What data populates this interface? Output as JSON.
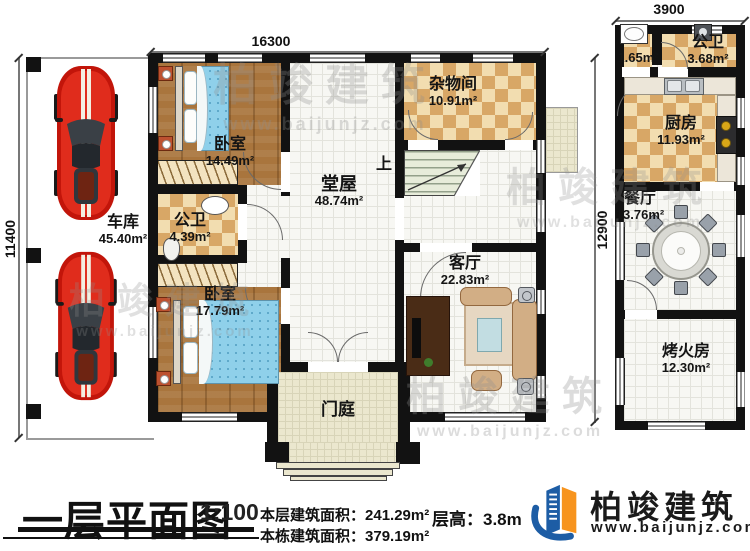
{
  "dimensions": {
    "main_width": "16300",
    "right_width": "3900",
    "left_height": "11400",
    "right_height": "12900"
  },
  "rooms": {
    "garage": {
      "name": "车库",
      "area": "45.40m²"
    },
    "bedroom1": {
      "name": "卧室",
      "area": "14.49m²"
    },
    "bath_main": {
      "name": "公卫",
      "area": "4.39m²"
    },
    "bedroom2": {
      "name": "卧室",
      "area": "17.79m²"
    },
    "hall": {
      "name": "堂屋",
      "area": "48.74m²"
    },
    "storage": {
      "name": "杂物间",
      "area": "10.91m²"
    },
    "living": {
      "name": "客厅",
      "area": "22.83m²"
    },
    "porch": {
      "name": "门庭"
    },
    "bath_small": {
      "area": "1.65m²"
    },
    "bath2": {
      "name": "公卫",
      "area": "3.68m²"
    },
    "kitchen": {
      "name": "厨房",
      "area": "11.93m²"
    },
    "dining": {
      "name": "餐厅",
      "area": "13.76m²"
    },
    "fire_room": {
      "name": "烤火房",
      "area": "12.30m²"
    }
  },
  "stairs": {
    "up_label": "上"
  },
  "title_block": {
    "plan_title": "一层平面图",
    "scale": "1:100",
    "floor_area_label": "本层建筑面积：",
    "floor_area_value": "241.29m²",
    "building_area_label": "本栋建筑面积：",
    "building_area_value": "379.19m²",
    "floor_height_label": "层高：",
    "floor_height_value": "3.8m"
  },
  "brand": {
    "name": "柏竣建筑",
    "website": "www.baijunjz.com"
  },
  "colors": {
    "wall": "#121212",
    "checker_light": "#f2ddb0",
    "checker_dark": "#d8a766",
    "wood_floor": "#a9753d",
    "car_red": "#d82012",
    "bed_blue": "#8fd0ea",
    "brand_blue": "#1d5da5",
    "brand_orange": "#f7941e"
  }
}
